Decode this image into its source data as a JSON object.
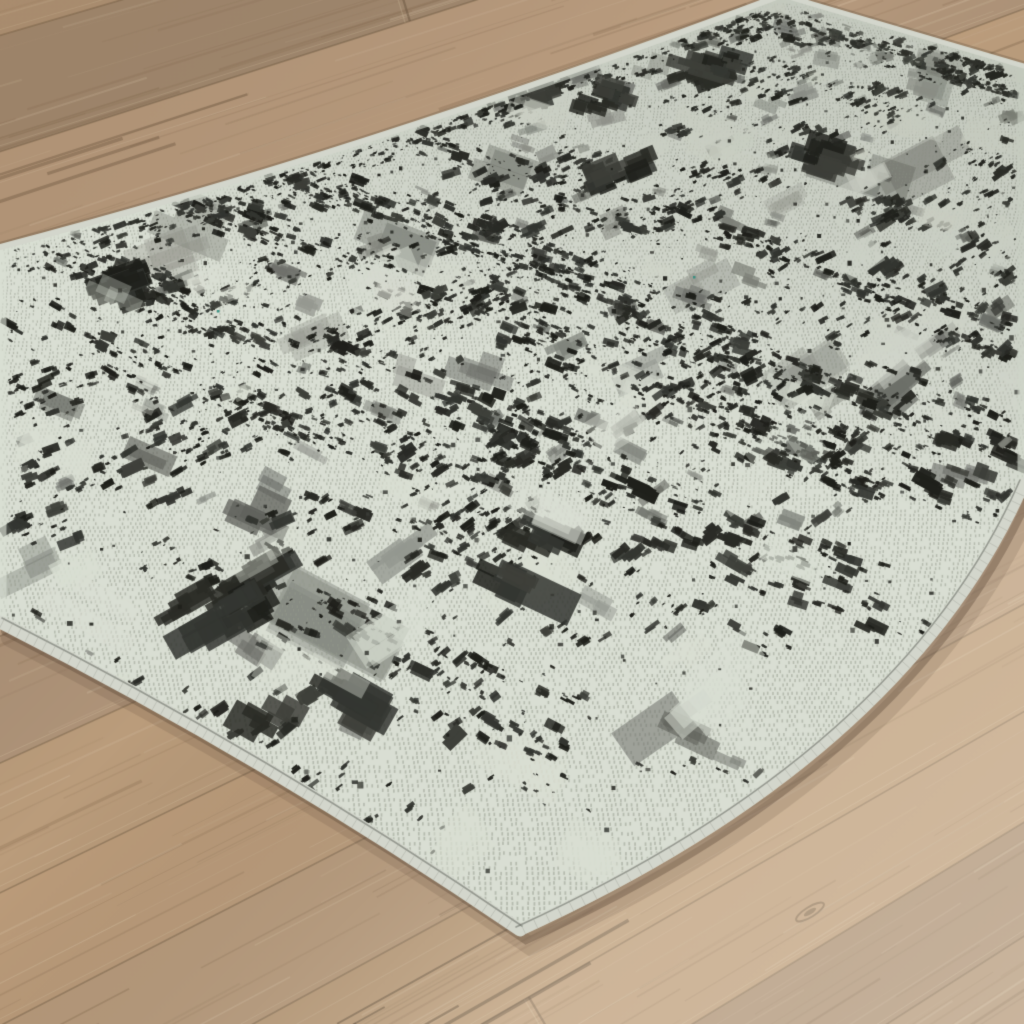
{
  "scene": {
    "description": "High-angle product photograph of a distressed abstract black, gray and ivory flatweave area rug lying diagonally on a light oak wood plank floor",
    "seed": 7
  },
  "canvas": {
    "width": 1024,
    "height": 1024
  },
  "floor": {
    "vp": [
      4466,
      -1271
    ],
    "phi_start": 2.5,
    "plank_dphi": 0.0238,
    "plank_count": 17,
    "r_near": 3350,
    "r_far": 5400,
    "base_color": "#b5987a",
    "tint_amp": 0.07,
    "grain_dark": "#7e6449",
    "grain_light": "#e8d8bc",
    "seam_color": "#6b5741",
    "seam_light": "#dcc9aa",
    "grain_per_plank": 46,
    "butt_joint_count": 6,
    "knot": {
      "pos": [
        810,
        912
      ],
      "color": "rgba(112,90,66,0.55)"
    },
    "streak_zones": [
      {
        "phi": 2.625,
        "r": 4560,
        "count": 8,
        "color": "rgba(90,71,52,0.5)"
      },
      {
        "phi": 2.832,
        "r": 4590,
        "count": 5,
        "color": "rgba(110,88,64,0.4)"
      }
    ],
    "light_overlay": {
      "from": "rgba(110,80,50,0.17)",
      "mid": "rgba(0,0,0,0)",
      "to_a": "rgba(255,248,236,0.26)",
      "to_b": "rgba(255,250,240,0.32)"
    }
  },
  "rug": {
    "quad": {
      "top": [
        782,
        -5
      ],
      "right": [
        1370,
        155
      ],
      "bottom": [
        520,
        930
      ],
      "left": [
        -410,
        379
      ]
    },
    "outline": {
      "left_border_top": [
        0,
        247
      ],
      "topleft_ctrl": [
        370,
        150
      ],
      "top_corner": [
        782,
        -5
      ],
      "right_border_top": [
        1024,
        66
      ],
      "right_border_enter": [
        1024,
        483
      ],
      "right_ctrl": [
        905,
        755
      ],
      "bottom_corner": [
        520,
        930
      ],
      "bottomleft_ctrl": [
        268,
        758
      ],
      "left_border_bottom": [
        0,
        622
      ]
    },
    "center": [
      540,
      420
    ],
    "colors": {
      "ivory": "#d9ded3",
      "weave": "rgba(148,154,140,0.5)",
      "charcoal": [
        "#1f201b",
        "#2a2b26",
        "#343631",
        "#3e403a"
      ],
      "gray": [
        "#5f615b",
        "#70726c",
        "#82857d",
        "#94978f"
      ],
      "ivory_patch": "rgba(217,222,210,0.78)",
      "binding": "#d3d6cc",
      "binding_tick": "rgba(158,161,151,0.38)",
      "binding_inner": "rgba(88,91,83,0.5)",
      "shadow": "rgba(78,62,45,0.33)",
      "shadow_soft": "rgba(78,62,45,0.15)",
      "far_shade": "rgba(75,80,70,0.15)",
      "fleck": "#3f9486"
    },
    "flecks": [
      [
        217,
        310
      ],
      [
        693,
        276
      ]
    ],
    "pattern": {
      "margin_scale": 0.982,
      "band_outer_scale": 0.975,
      "band_inner_scale": 0.94,
      "gray_washes": 26,
      "gray_patches": 240,
      "ivory_patches": 85,
      "u_bands": 13,
      "v_bands": 13,
      "clusters_per_band": 40,
      "mega_clumps": 20,
      "single_dots": 780,
      "border_tries": 1600,
      "blob_min": 3,
      "blob_max": 13.5
    },
    "binding_widths": {
      "topleft": 6,
      "topright": 5,
      "right": 12,
      "bottomleft": 13
    }
  }
}
